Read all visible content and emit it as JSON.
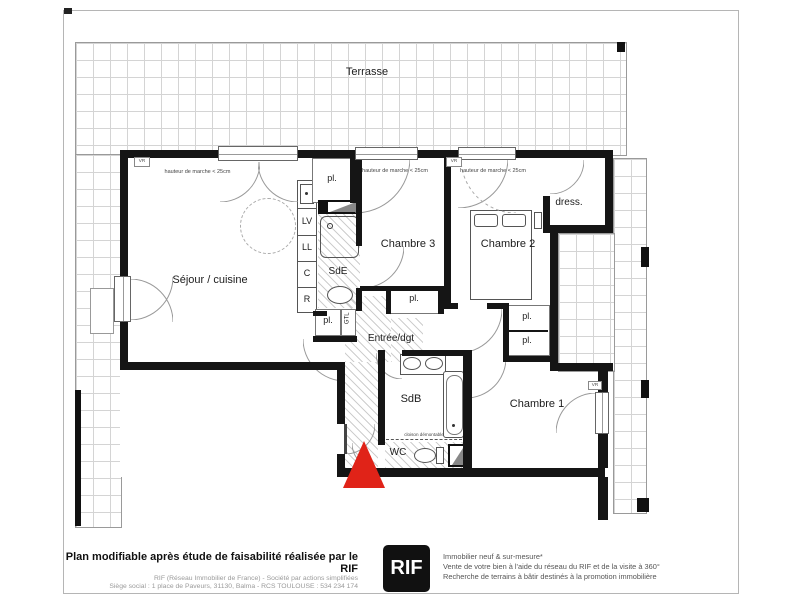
{
  "plan": {
    "terrasse": "Terrasse",
    "sejour": "Séjour / cuisine",
    "chambre1": "Chambre 1",
    "chambre2": "Chambre 2",
    "chambre3": "Chambre 3",
    "sde": "SdE",
    "sdb": "SdB",
    "wc": "WC",
    "entree": "Entrée/dgt",
    "dress": "dress.",
    "closet": "pl.",
    "gtl": "GTL",
    "lv": "LV",
    "ll": "LL",
    "c": "C",
    "r": "R",
    "vr": "VR",
    "step_note": "hauteur de marche < 25cm",
    "partition_note": "cloison démontable",
    "marker_red": "#e02318"
  },
  "footer": {
    "left_bold": "Plan modifiable après étude de faisabilité réalisée par le RIF",
    "left_line2": "RIF (Réseau Immobilier de France) - Société par actions simplifiées",
    "left_line3": "Siège social : 1 place de Paveurs, 31130, Balma - RCS TOULOUSE : 534 234 174",
    "logo": "RIF",
    "right_line1": "Immobilier neuf & sur-mesure*",
    "right_line2": "Vente de votre bien à l'aide du réseau du RIF et de la visite à 360°",
    "right_line3": "Recherche de terrains à bâtir destinés à la promotion immobilière"
  }
}
